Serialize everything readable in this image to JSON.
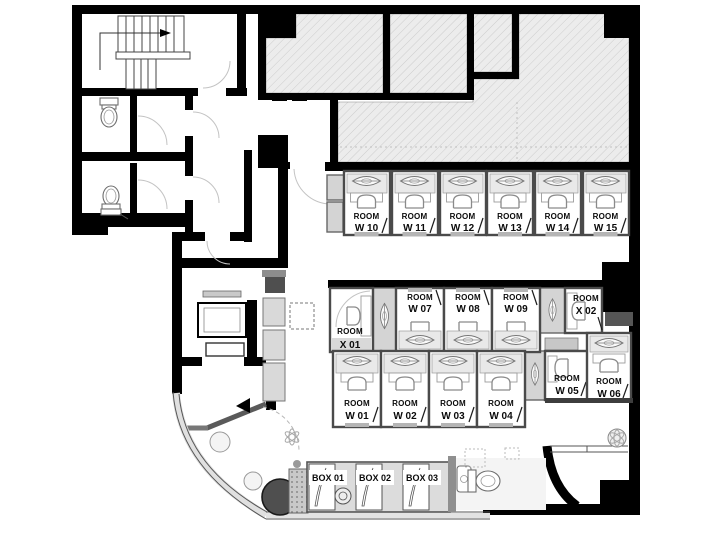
{
  "plan": {
    "rooms": {
      "top_row": [
        {
          "l1": "ROOM",
          "l2": "W 10"
        },
        {
          "l1": "ROOM",
          "l2": "W 11"
        },
        {
          "l1": "ROOM",
          "l2": "W 12"
        },
        {
          "l1": "ROOM",
          "l2": "W 13"
        },
        {
          "l1": "ROOM",
          "l2": "W 14"
        },
        {
          "l1": "ROOM",
          "l2": "W 15"
        }
      ],
      "mid_row": [
        {
          "l1": "ROOM",
          "l2": "W 07"
        },
        {
          "l1": "ROOM",
          "l2": "W 08"
        },
        {
          "l1": "ROOM",
          "l2": "W 09"
        }
      ],
      "bottom_row": [
        {
          "l1": "ROOM",
          "l2": "W 01"
        },
        {
          "l1": "ROOM",
          "l2": "W 02"
        },
        {
          "l1": "ROOM",
          "l2": "W 03"
        },
        {
          "l1": "ROOM",
          "l2": "W 04"
        }
      ],
      "x01": {
        "l1": "ROOM",
        "l2": "X 01"
      },
      "x02": {
        "l1": "ROOM",
        "l2": "X 02"
      },
      "w05": {
        "l1": "ROOM",
        "l2": "W 05"
      },
      "w06": {
        "l1": "ROOM",
        "l2": "W 06"
      }
    },
    "boxes": [
      {
        "label": "BOX 01"
      },
      {
        "label": "BOX 02"
      },
      {
        "label": "BOX 03"
      }
    ],
    "colors": {
      "wall": "#000000",
      "booth_border": "#4a4a4a",
      "hatch_fill": "#ececec",
      "hatch_line": "#cccccc",
      "fixture_gray": "#d9d9d9",
      "dark_table": "#4f4f4f"
    }
  }
}
